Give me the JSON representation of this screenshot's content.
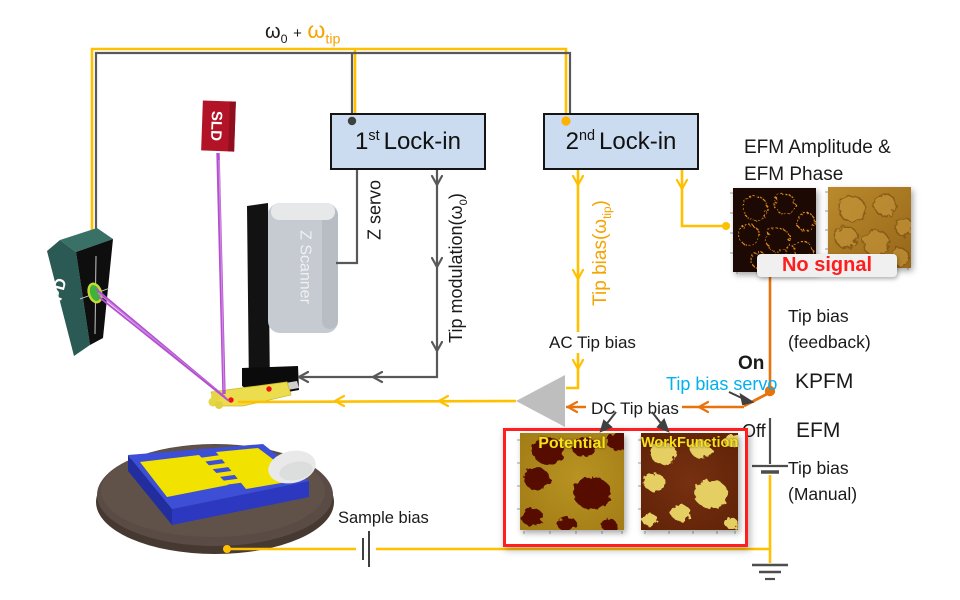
{
  "colors": {
    "yellow": "#FFC000",
    "greyWire": "#58585A",
    "orange": "#E8720C",
    "purple": "#B44FD0",
    "cyan": "#00B0F0",
    "redAccent": "#FF1F1F",
    "lockinFill": "#CBDCF0",
    "sldRed": "#B31326",
    "pspdTeal": "#2B5953",
    "triangleGrey": "#BEBEBE",
    "noSignalBg": "#F0F0F0"
  },
  "top_label": {
    "omega0": "ω",
    "omega0_sub": "0",
    "plus": "+",
    "omegatip": "ω",
    "omegatip_sub": "tip"
  },
  "devices": {
    "sld": "SLD",
    "pspd": "PSPD",
    "z_scanner": "Z Scanner"
  },
  "lockin1": {
    "num": "1",
    "sup": "st",
    "rest": "Lock-in"
  },
  "lockin2": {
    "num": "2",
    "sup": "nd",
    "rest": "Lock-in"
  },
  "wires": {
    "z_servo": "Z servo",
    "tip_modulation_pre": "Tip modulation(ω",
    "tip_modulation_sub": "0",
    "tip_modulation_post": ")",
    "tip_bias_pre": "Tip bias(ω",
    "tip_bias_sub": "tip",
    "tip_bias_post": ")",
    "ac_tip_bias": "AC Tip bias",
    "dc_tip_bias": "DC Tip bias",
    "sample_bias": "Sample bias"
  },
  "efm_output": {
    "title_line1": "EFM Amplitude &",
    "title_line2": "EFM Phase",
    "no_signal": "No signal"
  },
  "kpfm": {
    "on": "On",
    "servo": "Tip bias servo",
    "mode": "KPFM",
    "feedback_line1": "Tip bias",
    "feedback_line2": "(feedback)"
  },
  "efm": {
    "off": "Off",
    "mode": "EFM",
    "manual_line1": "Tip bias",
    "manual_line2": "(Manual)"
  },
  "maps": {
    "potential": "Potential",
    "workfunction": "WorkFunction"
  }
}
